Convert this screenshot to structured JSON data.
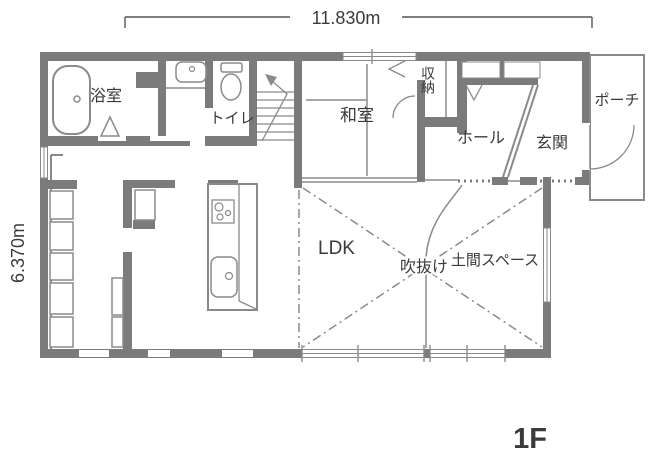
{
  "plan": {
    "floor_label": "1F",
    "dimensions": {
      "width": "11.830m",
      "height": "6.370m"
    },
    "rooms": {
      "bathroom": {
        "label": "浴室"
      },
      "toilet": {
        "label": "トイレ"
      },
      "japanese_room": {
        "label": "和室"
      },
      "storage": {
        "label": "収納"
      },
      "hall": {
        "label": "ホール"
      },
      "entrance": {
        "label": "玄関"
      },
      "porch": {
        "label": "ポーチ"
      },
      "ldk": {
        "label": "LDK"
      },
      "atrium_void": {
        "label": "吹抜け"
      },
      "doma_space": {
        "label": "土間スペース"
      }
    },
    "colors": {
      "wall": "#7b7b7b",
      "line": "#8a8a8a",
      "text": "#3a3a3a",
      "background": "#ffffff"
    }
  }
}
